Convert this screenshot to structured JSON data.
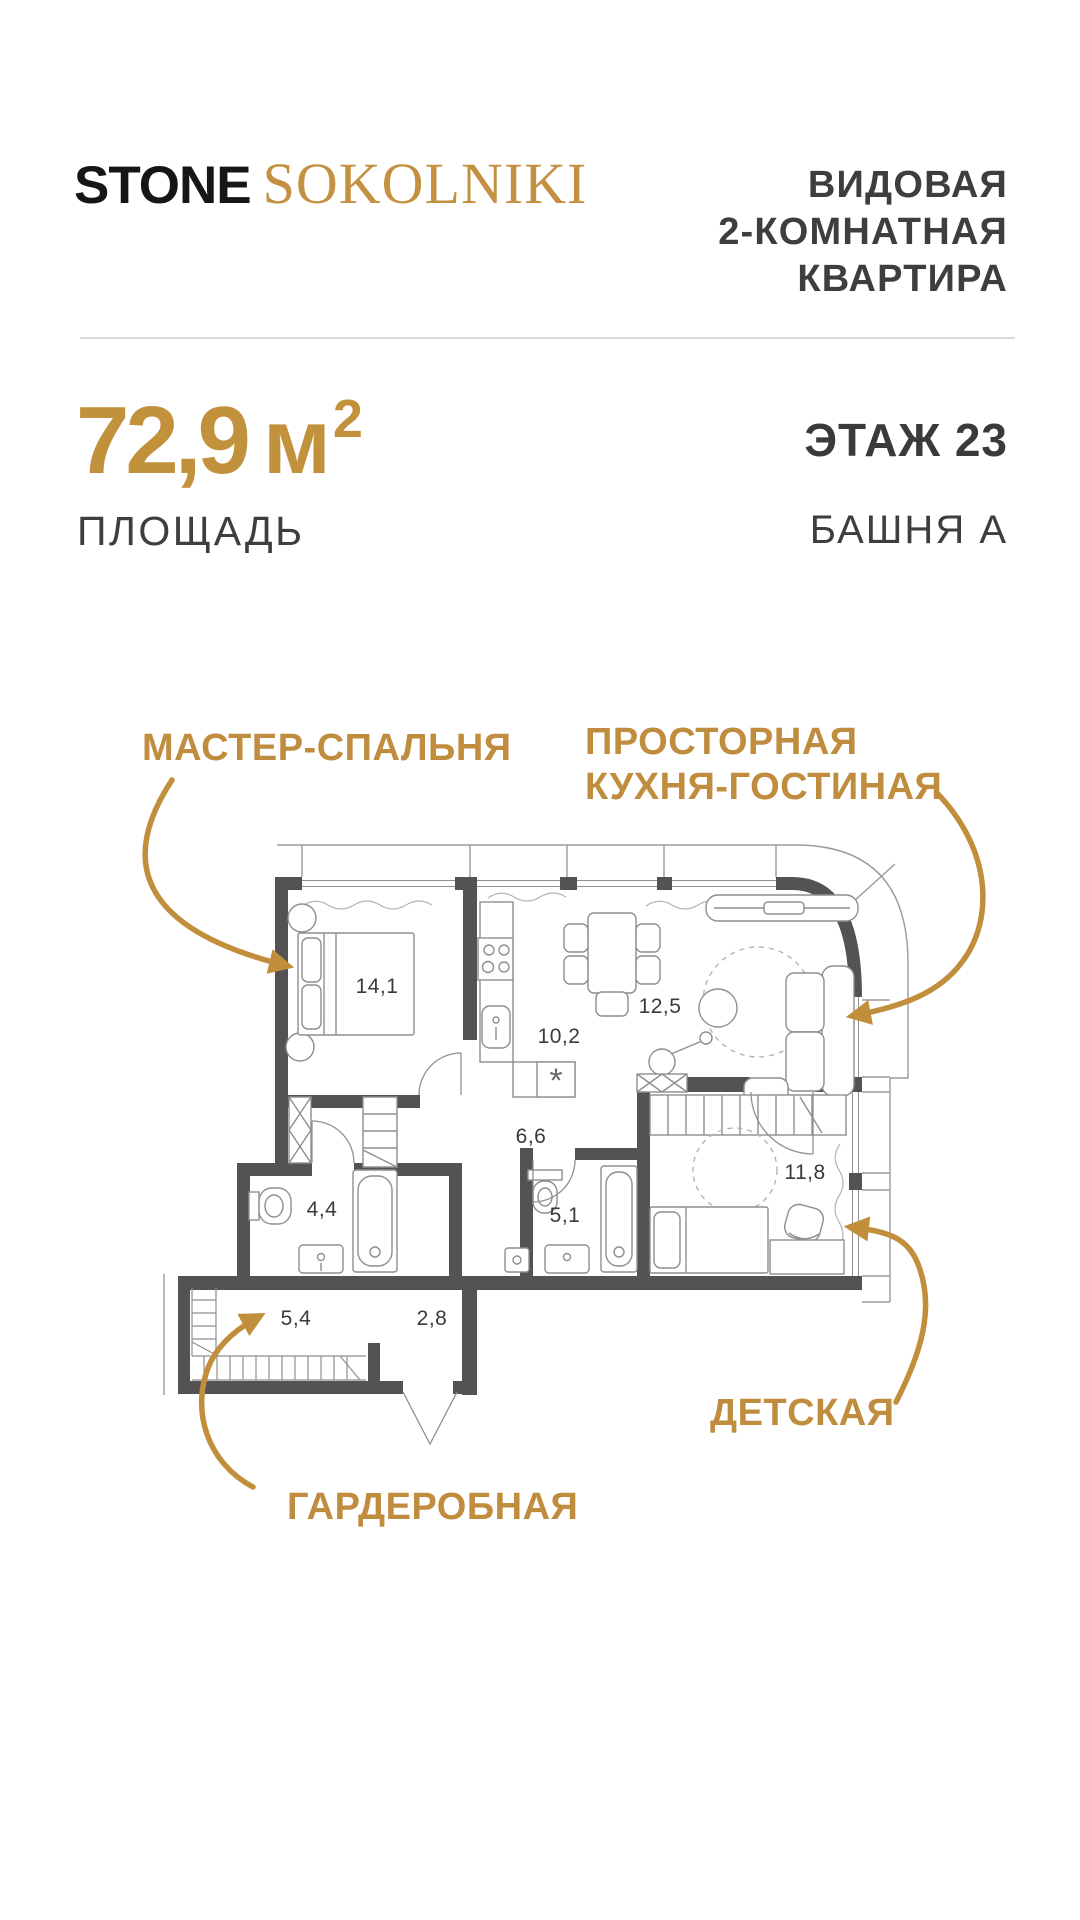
{
  "brand": {
    "name_primary": "STONE",
    "name_secondary": "SOKOLNIKI"
  },
  "header": {
    "title_line1": "ВИДОВАЯ",
    "title_line2": "2-КОМНАТНАЯ",
    "title_line3": "КВАРТИРА"
  },
  "summary": {
    "area_value": "72,9",
    "area_unit": "м",
    "area_superscript": "2",
    "area_caption": "ПЛОЩАДЬ",
    "floor_label": "ЭТАЖ 23",
    "tower_label": "БАШНЯ А"
  },
  "plan": {
    "callouts": {
      "master": "МАСТЕР-СПАЛЬНЯ",
      "kitchen_line1": "ПРОСТОРНАЯ",
      "kitchen_line2": "КУХНЯ-ГОСТИНАЯ",
      "kids": "ДЕТСКАЯ",
      "wardrobe": "ГАРДЕРОБНАЯ"
    },
    "rooms": [
      {
        "name": "master-bedroom",
        "area": "14,1"
      },
      {
        "name": "kitchen",
        "area": "10,2"
      },
      {
        "name": "living-room",
        "area": "12,5"
      },
      {
        "name": "corridor",
        "area": "6,6"
      },
      {
        "name": "bathroom",
        "area": "4,4"
      },
      {
        "name": "bathroom-2",
        "area": "5,1"
      },
      {
        "name": "kids-room",
        "area": "11,8"
      },
      {
        "name": "wardrobe-room",
        "area": "5,4"
      },
      {
        "name": "hallway",
        "area": "2,8"
      }
    ],
    "symbols": {
      "appliance_marker": "*"
    }
  },
  "colors": {
    "accent": "#C18E3C",
    "logo_serif": "#C49041",
    "wall": "#535355",
    "text_dark": "#3A3A3C",
    "furniture_line": "#8E8E90",
    "divider": "#D9D9D9"
  }
}
